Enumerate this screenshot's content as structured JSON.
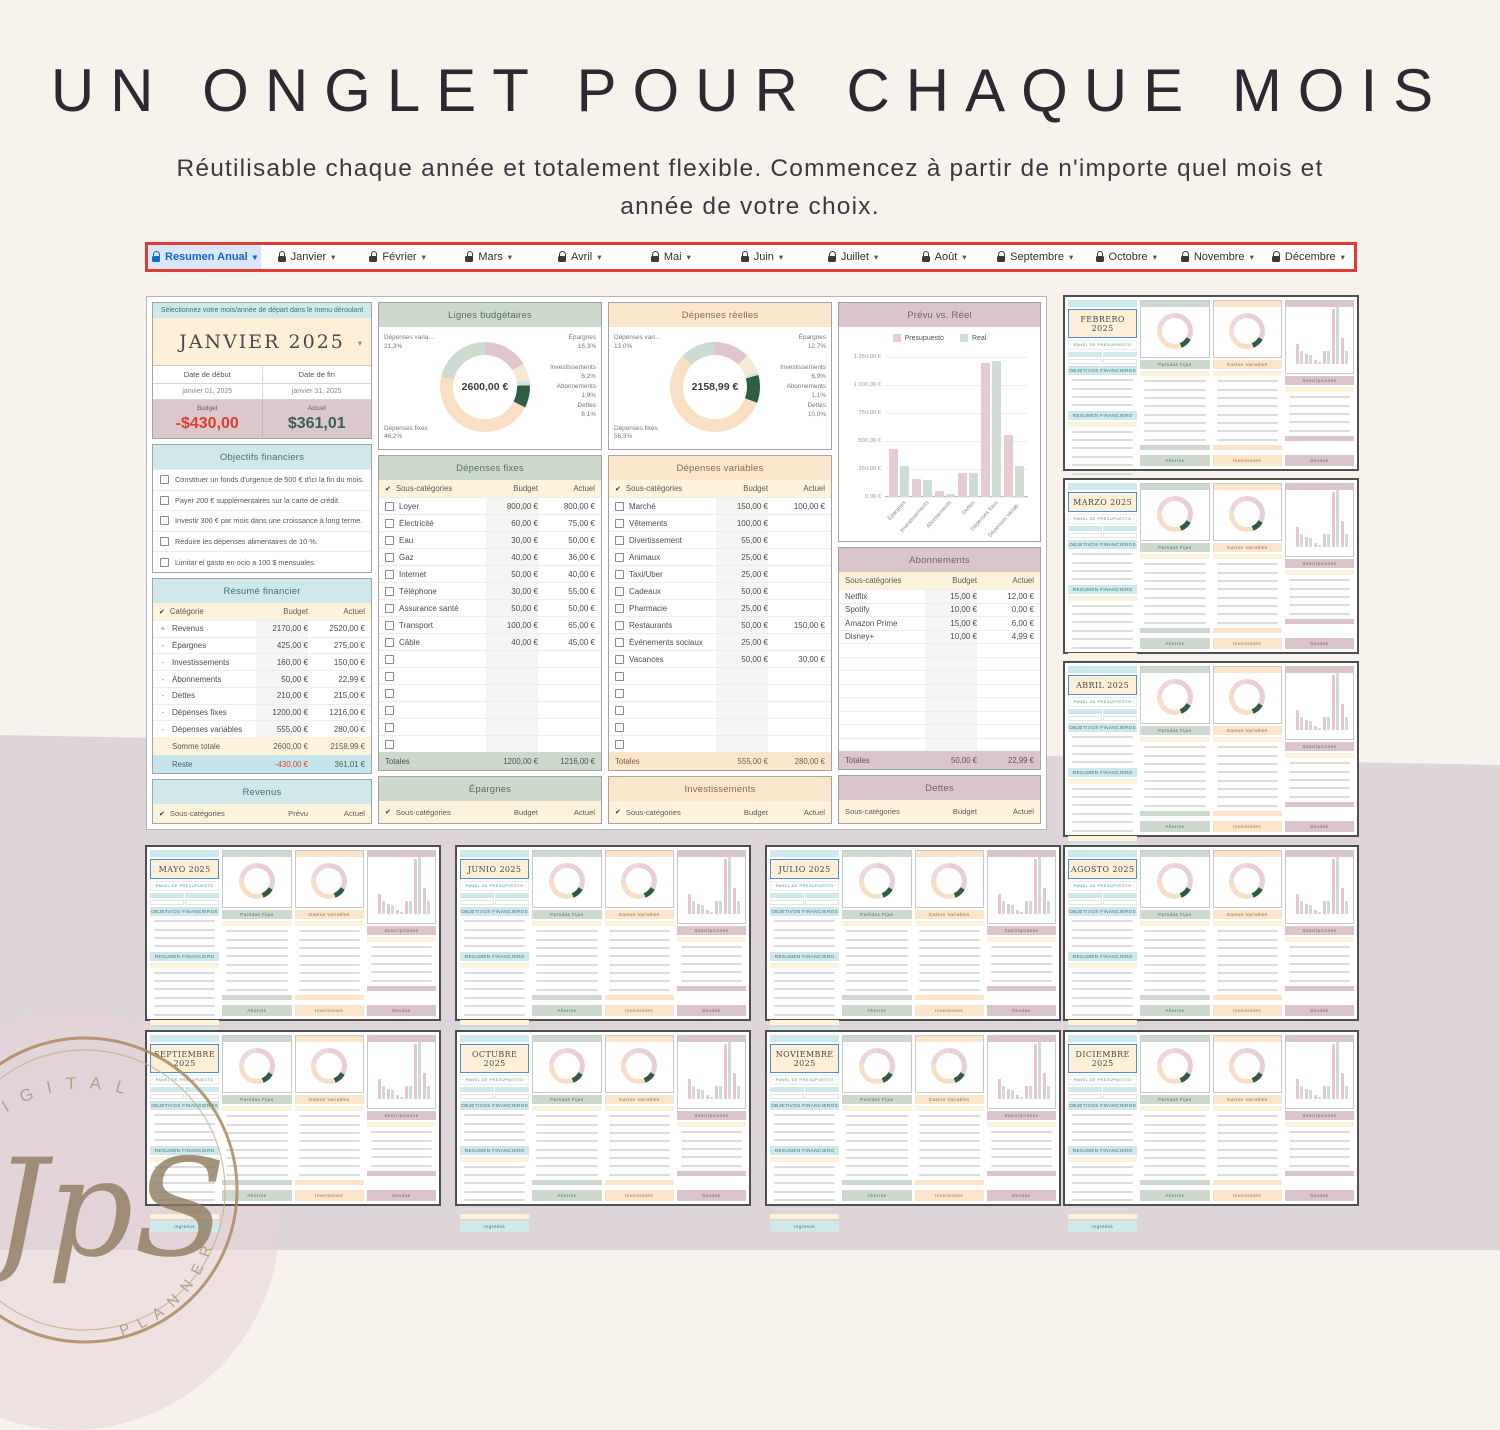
{
  "page": {
    "title": "UN ONGLET POUR CHAQUE MOIS",
    "subtitle": "Réutilisable chaque année et totalement flexible. Commencez à partir de n'importe quel mois et année de votre choix."
  },
  "tabbar": {
    "active": "Resumen Anual",
    "tabs": [
      "Janvier",
      "Février",
      "Mars",
      "Avril",
      "Mai",
      "Juin",
      "Juillet",
      "Août",
      "Septembre",
      "Octobre",
      "Novembre",
      "Décembre"
    ]
  },
  "sheet": {
    "selector": {
      "instruction": "Sélectionnez votre mois/année de départ dans le menu déroulant",
      "month": "JANVIER 2025",
      "date_start_label": "Date de début",
      "date_end_label": "Date de fin",
      "date_start": "janvier 01, 2025",
      "date_end": "janvier 31, 2025",
      "budget_label": "Budget",
      "actual_label": "Actuel",
      "budget_value": "-$430,00",
      "actual_value": "$361,01"
    },
    "objectives": {
      "title": "Objectifs financiers",
      "items": [
        "Constituer un fonds d'urgence de 500 € d'ici la fin du mois.",
        "Payer 200 € supplémentaires sur la carte de crédit.",
        "Investir 300 € par mois dans une croissance à long terme.",
        "Réduire les dépenses alimentaires de 10 %.",
        "Limitar el gasto en ocio a 100 $ mensuales."
      ]
    },
    "summary": {
      "title": "Résumé financier",
      "columns": [
        "Catégorie",
        "Budget",
        "Actuel"
      ],
      "rows": [
        {
          "sign": "+",
          "label": "Revenus",
          "budget": "2170,00 €",
          "actual": "2520,00 €"
        },
        {
          "sign": "-",
          "label": "Épargnes",
          "budget": "425,00 €",
          "actual": "275,00 €"
        },
        {
          "sign": "-",
          "label": "Investissements",
          "budget": "160,00 €",
          "actual": "150,00 €"
        },
        {
          "sign": "-",
          "label": "Abonnements",
          "budget": "50,00 €",
          "actual": "22,99 €"
        },
        {
          "sign": "-",
          "label": "Dettes",
          "budget": "210,00 €",
          "actual": "215,00 €"
        },
        {
          "sign": "-",
          "label": "Dépenses fixes",
          "budget": "1200,00 €",
          "actual": "1216,00 €"
        },
        {
          "sign": "-",
          "label": "Dépenses variables",
          "budget": "555,00 €",
          "actual": "280,00 €"
        }
      ],
      "total": {
        "label": "Somme totale",
        "budget": "2600,00 €",
        "actual": "2158,99 €"
      },
      "rest": {
        "label": "Reste",
        "budget": "-430,00 €",
        "actual": "361,01 €"
      }
    },
    "fixed": {
      "title": "Dépenses fixes",
      "columns": [
        "Sous-catégories",
        "Budget",
        "Actuel"
      ],
      "rows": [
        {
          "label": "Loyer",
          "budget": "800,00 €",
          "actual": "800,00 €"
        },
        {
          "label": "Électricité",
          "budget": "60,00 €",
          "actual": "75,00 €"
        },
        {
          "label": "Eau",
          "budget": "30,00 €",
          "actual": "50,00 €"
        },
        {
          "label": "Gaz",
          "budget": "40,00 €",
          "actual": "36,00 €"
        },
        {
          "label": "Internet",
          "budget": "50,00 €",
          "actual": "40,00 €"
        },
        {
          "label": "Téléphone",
          "budget": "30,00 €",
          "actual": "55,00 €"
        },
        {
          "label": "Assurance santé",
          "budget": "50,00 €",
          "actual": "50,00 €"
        },
        {
          "label": "Transport",
          "budget": "100,00 €",
          "actual": "65,00 €"
        },
        {
          "label": "Câble",
          "budget": "40,00 €",
          "actual": "45,00 €"
        }
      ],
      "empty_rows": 6,
      "total": {
        "label": "Totales",
        "budget": "1200,00 €",
        "actual": "1216,00 €"
      }
    },
    "variable": {
      "title": "Dépenses variables",
      "columns": [
        "Sous-catégories",
        "Budget",
        "Actuel"
      ],
      "rows": [
        {
          "label": "Marché",
          "budget": "150,00 €",
          "actual": "100,00 €"
        },
        {
          "label": "Vêtements",
          "budget": "100,00 €",
          "actual": ""
        },
        {
          "label": "Divertissement",
          "budget": "55,00 €",
          "actual": ""
        },
        {
          "label": "Animaux",
          "budget": "25,00 €",
          "actual": ""
        },
        {
          "label": "Taxi/Uber",
          "budget": "25,00 €",
          "actual": ""
        },
        {
          "label": "Cadeaux",
          "budget": "50,00 €",
          "actual": ""
        },
        {
          "label": "Pharmacie",
          "budget": "25,00 €",
          "actual": ""
        },
        {
          "label": "Restaurants",
          "budget": "50,00 €",
          "actual": "150,00 €"
        },
        {
          "label": "Événements sociaux",
          "budget": "25,00 €",
          "actual": ""
        },
        {
          "label": "Vacances",
          "budget": "50,00 €",
          "actual": "30,00 €"
        }
      ],
      "empty_rows": 5,
      "total": {
        "label": "Totales",
        "budget": "555,00 €",
        "actual": "280,00 €"
      }
    },
    "subscriptions": {
      "title": "Abonnements",
      "columns": [
        "Sous-catégories",
        "Budget",
        "Actuel"
      ],
      "rows": [
        {
          "label": "Netflix",
          "budget": "15,00 €",
          "actual": "12,00 €"
        },
        {
          "label": "Spotify",
          "budget": "10,00 €",
          "actual": "0,00 €"
        },
        {
          "label": "Amazon Prime",
          "budget": "15,00 €",
          "actual": "6,00 €"
        },
        {
          "label": "Disney+",
          "budget": "10,00 €",
          "actual": "4,99 €"
        }
      ],
      "empty_rows": 8,
      "total": {
        "label": "Totales",
        "budget": "50,00 €",
        "actual": "22,99 €"
      }
    },
    "footers": [
      {
        "title": "Revenus",
        "accent": "teal",
        "check": true,
        "columns": [
          "Sous-catégories",
          "Prévu",
          "Actuel"
        ]
      },
      {
        "title": "Épargnes",
        "accent": "sage",
        "check": true,
        "columns": [
          "Sous-catégories",
          "Budget",
          "Actuel"
        ]
      },
      {
        "title": "Investissements",
        "accent": "peach",
        "check": true,
        "columns": [
          "Sous-catégories",
          "Budget",
          "Actuel"
        ]
      },
      {
        "title": "Dettes",
        "accent": "mauve",
        "check": false,
        "columns": [
          "Sous-catégories",
          "Budget",
          "Actuel"
        ]
      }
    ]
  },
  "chart_data": [
    {
      "type": "pie",
      "title": "Lignes budgétaires",
      "center_total": "2600,00 €",
      "segments": [
        {
          "label": "Épargnes",
          "pct": 16.3,
          "color": "#dfc6ce"
        },
        {
          "label": "Investissements",
          "pct": 6.2,
          "color": "#f7ead2"
        },
        {
          "label": "Abonnements",
          "pct": 1.9,
          "color": "#cfe3e6"
        },
        {
          "label": "Dettes",
          "pct": 8.1,
          "color": "#2f5c42"
        },
        {
          "label": "Dépenses fixes",
          "pct": 46.2,
          "color": "#f9dfc3"
        },
        {
          "label": "Dépenses variables",
          "pct": 21.3,
          "color": "#ccdcd1"
        }
      ],
      "labels": [
        {
          "text": "Dépenses varia...",
          "pct": "21,3%",
          "slot": "tl"
        },
        {
          "text": "Épargnes",
          "pct": "16,3%",
          "slot": "tr"
        },
        {
          "text": "Investissements",
          "pct": "6,2%",
          "slot": "r1"
        },
        {
          "text": "Abonnements",
          "pct": "1,9%",
          "slot": "r2"
        },
        {
          "text": "Dettes",
          "pct": "8,1%",
          "slot": "r3"
        },
        {
          "text": "Dépenses fixes",
          "pct": "46,2%",
          "slot": "bl"
        }
      ]
    },
    {
      "type": "pie",
      "title": "Dépenses réelles",
      "center_total": "2158,99 €",
      "segments": [
        {
          "label": "Épargnes",
          "pct": 12.7,
          "color": "#dfc6ce"
        },
        {
          "label": "Investissements",
          "pct": 6.9,
          "color": "#f7ead2"
        },
        {
          "label": "Abonnements",
          "pct": 1.1,
          "color": "#cfe3e6"
        },
        {
          "label": "Dettes",
          "pct": 10.0,
          "color": "#2f5c42"
        },
        {
          "label": "Dépenses fixes",
          "pct": 56.3,
          "color": "#f9dfc3"
        },
        {
          "label": "Dépenses variables",
          "pct": 13.0,
          "color": "#ccdcd1"
        }
      ],
      "labels": [
        {
          "text": "Dépenses vari...",
          "pct": "13,0%",
          "slot": "tl"
        },
        {
          "text": "Épargnes",
          "pct": "12,7%",
          "slot": "tr"
        },
        {
          "text": "Investissements",
          "pct": "6,9%",
          "slot": "r1"
        },
        {
          "text": "Abonnements",
          "pct": "1,1%",
          "slot": "r2"
        },
        {
          "text": "Dettes",
          "pct": "10,0%",
          "slot": "r3"
        },
        {
          "text": "Dépenses fixes",
          "pct": "56,3%",
          "slot": "bl"
        }
      ]
    },
    {
      "type": "bar",
      "title": "Prévu vs. Réel",
      "legend": [
        "Presupuesto",
        "Real"
      ],
      "categories": [
        "Épargnes",
        "Investissements",
        "Abonnements",
        "Dettes",
        "Dépenses fixes",
        "Dépenses variab..."
      ],
      "series": [
        {
          "name": "Presupuesto",
          "values": [
            425,
            160,
            50,
            210,
            1200,
            555
          ]
        },
        {
          "name": "Real",
          "values": [
            275,
            150,
            22.99,
            215,
            1216,
            280
          ]
        }
      ],
      "yticks": [
        "1 250,00 €",
        "1 000,00 €",
        "750,00 €",
        "500,00 €",
        "250,00 €",
        "0,00 €"
      ],
      "ylim": [
        0,
        1250
      ]
    }
  ],
  "thumbnails": {
    "subtitle": "PANEL DE PRESUPUESTO",
    "sections": {
      "objectives": "OBJETIVOS FINANCIEROS",
      "summary": "RESUMEN FINANCIERO",
      "fixed": "Partidas Fijas",
      "variable": "Gastos Variables",
      "subscriptions": "Suscripciones"
    },
    "footer": [
      "Ingresos",
      "Ahorros",
      "Inversiones",
      "Deudas"
    ],
    "months": [
      "FEBRERO 2025",
      "MARZO 2025",
      "ABRIL 2025",
      "MAYO 2025",
      "JUNIO 2025",
      "JULIO 2025",
      "AGOSTO 2025",
      "SEPTIEMBRE 2025",
      "OCTUBRE 2025",
      "NOVIEMBRE 2025",
      "DICIEMBRE 2025"
    ]
  },
  "watermark": {
    "arc_top": "DIGITAL",
    "arc_bottom": "PLANNER",
    "monogram": "JpS"
  }
}
